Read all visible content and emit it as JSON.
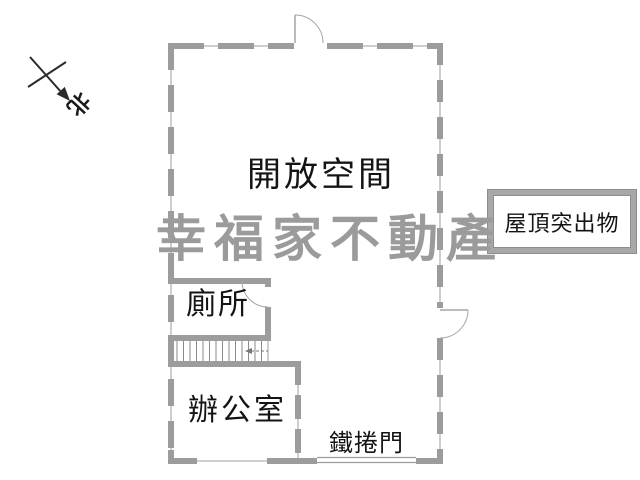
{
  "title": "floor-plan",
  "labels": {
    "open_space": "開放空間",
    "roof_protrusion": "屋頂突出物",
    "toilet": "廁所",
    "office": "辦公室",
    "roller_door": "鐵捲門",
    "north": "北"
  },
  "watermark": {
    "text": "幸福家不動產",
    "color": "#9b9b9b"
  },
  "colors": {
    "background": "#ffffff",
    "wall": "#9c9c9c",
    "wall_edge": "#8a8a8a",
    "label_text": "#141414",
    "compass": "#2b2b2b",
    "stair_tread": "#8a8a8a"
  }
}
